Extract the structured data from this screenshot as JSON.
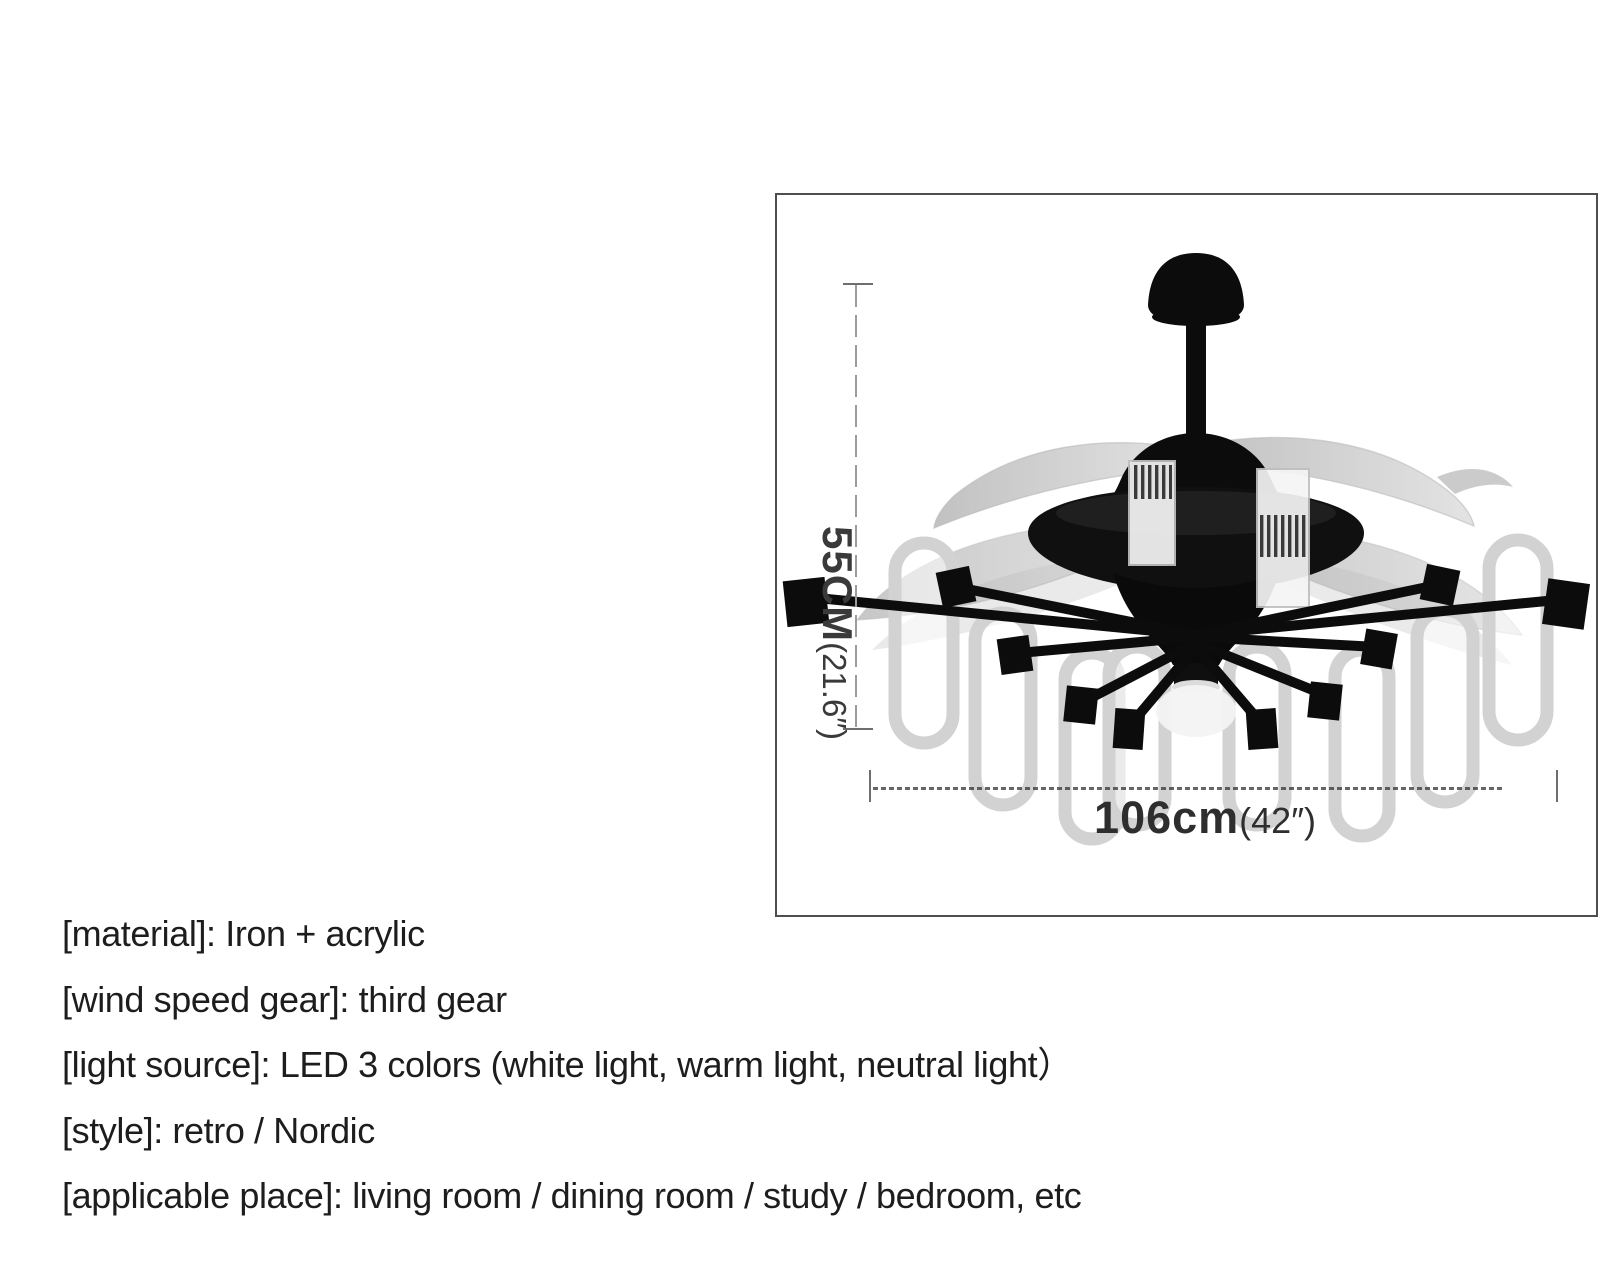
{
  "figure": {
    "alt": "ceiling-fan-with-retractable-blades-and-led-lights",
    "border_color": "#4e4e4e"
  },
  "dimensions": {
    "height": {
      "value": "55CM",
      "inches": "(21.6″)"
    },
    "width": {
      "value": "106cm",
      "inches": "(42″)"
    }
  },
  "specs": {
    "lines": [
      "[material]: Iron + acrylic",
      "[wind speed gear]: third gear",
      "[light source]: LED 3 colors (white light, warm light, neutral light）",
      "[style]: retro / Nordic",
      "[applicable place]: living room / dining room / study / bedroom, etc"
    ]
  },
  "colors": {
    "spec_text": "#1d1d1d",
    "dimension_text": "#3a3a3a",
    "dimension_line": "#9c9c9c",
    "fan_body": "#0c0c0c",
    "fan_blade": "#b0b0b0",
    "acrylic_shade": "#d8d8d8",
    "background": "#ffffff"
  }
}
